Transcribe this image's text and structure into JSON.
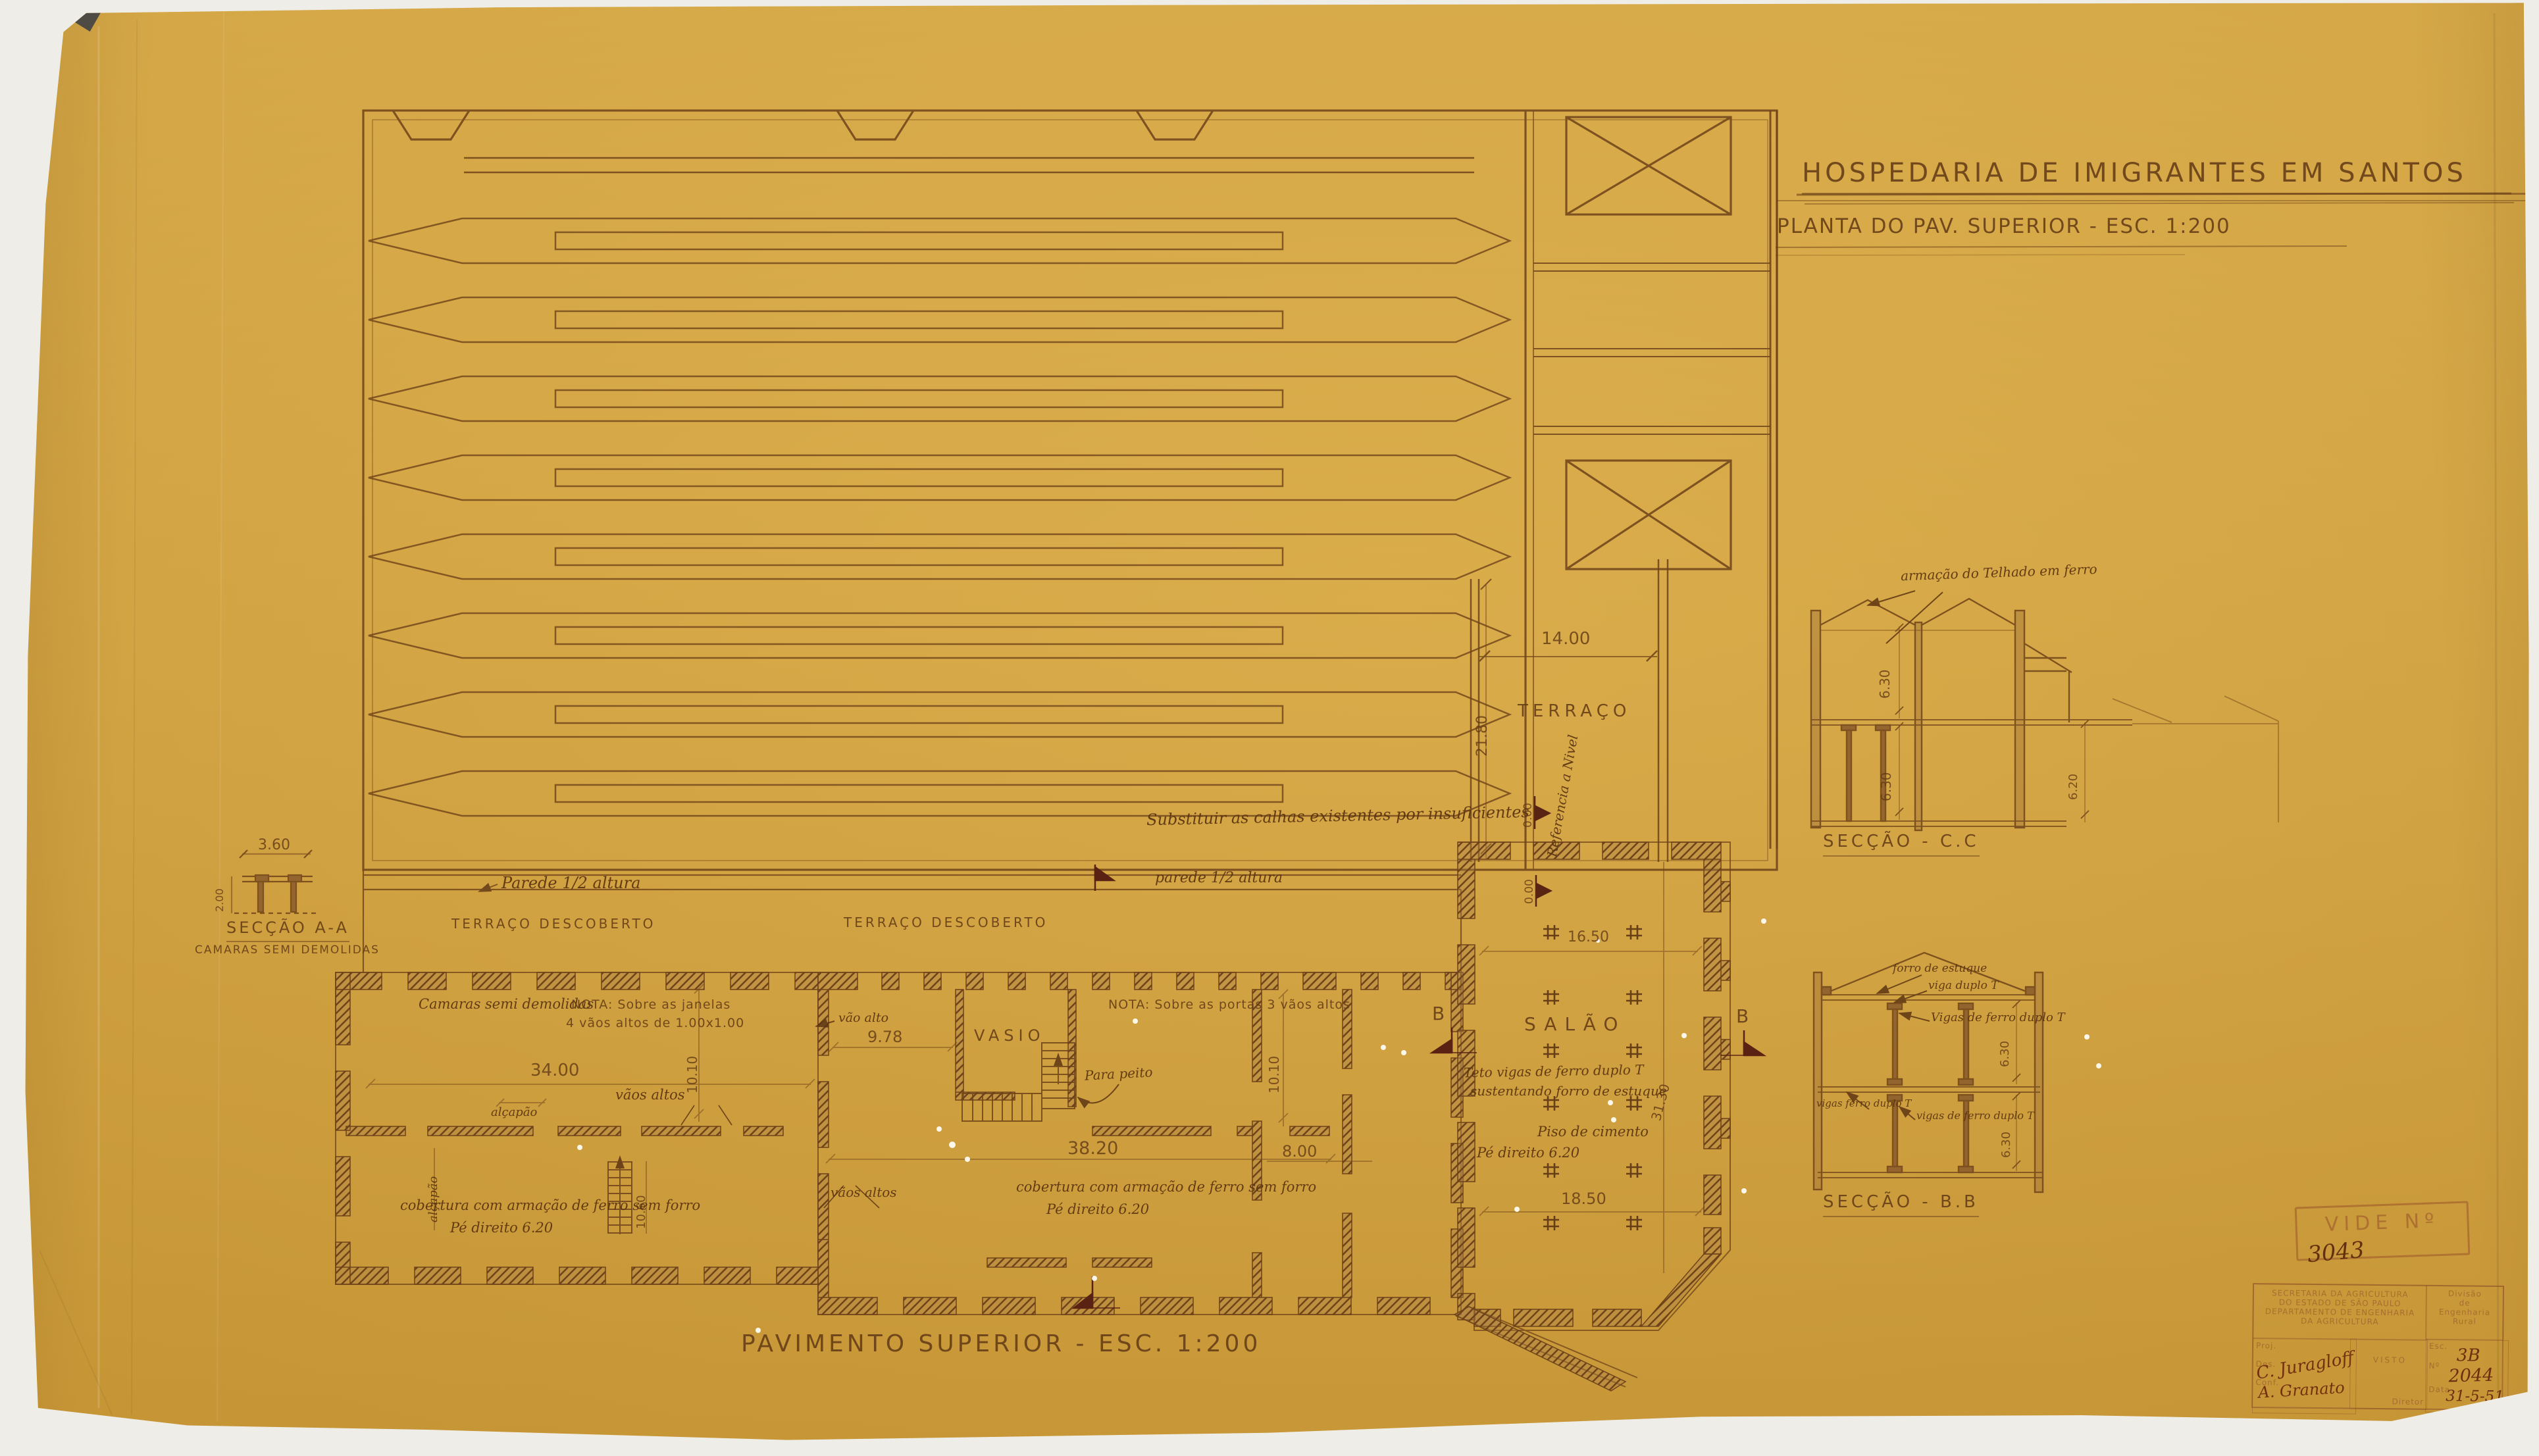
{
  "sheet": {
    "size_note": "53x95",
    "title1": "HOSPEDARIA DE IMIGRANTES EM SANTOS",
    "title2": "PLANTA DO PAV. SUPERIOR - ESC. 1:200",
    "caption": "PAVIMENTO SUPERIOR - ESC. 1:200"
  },
  "roof": {
    "gutter_note": "Substituir as calhas existentes por insuficientes",
    "half_wall_left": "Parede 1/2 altura",
    "half_wall_right": "parede 1/2 altura"
  },
  "terrace": {
    "label": "TERRAÇO",
    "w": "14.00",
    "d": "21.80",
    "ref": "Referencia a Nivel",
    "lvl1": "0.00",
    "lvl2": "0.00",
    "open_left": "TERRAÇO DESCOBERTO",
    "open_center": "TERRAÇO DESCOBERTO"
  },
  "left_block": {
    "chambers": "Camaras semi demolidas",
    "nota1": "NOTA: Sobre as janelas",
    "nota2": "4 vãos altos de 1.00x1.00",
    "w": "34.00",
    "vaos": "vãos altos",
    "alcapao": "alçapão",
    "alcapao_v": "alçapão",
    "d": "10.10",
    "stair": "10.60",
    "roof1": "cobertura com armação de ferro sem forro",
    "roof2": "Pé direito 6.20",
    "vaos2": "vãos altos"
  },
  "mid_block": {
    "vao": "vão alto",
    "w978": "9.78",
    "vasio": "VASIO",
    "peito": "Para peito",
    "nota": "NOTA: Sobre as portas 3 vãos altos",
    "d": "10.10",
    "w": "38.20",
    "w8": "8.00",
    "roof1": "cobertura com armação de ferro sem forro",
    "roof2": "Pé direito 6.20"
  },
  "salao": {
    "label": "SALÃO",
    "teto1": "Teto vigas de ferro duplo T",
    "teto2": "sustentando forro de estuque",
    "piso": "Piso de cimento",
    "pe": "Pé direito 6.20",
    "w": "16.50",
    "w2": "18.50",
    "d": "31.30"
  },
  "marks": {
    "bl": "B",
    "br": "B"
  },
  "sa": {
    "t": "SECÇÃO A-A",
    "sub": "CAMARAS SEMI DEMOLIDAS",
    "w": "3.60",
    "h": "2.00"
  },
  "sc": {
    "t": "SECÇÃO - C.C",
    "note": "armação do Telhado em ferro",
    "d1": "6.30",
    "d2": "6.30",
    "d3": "6.20"
  },
  "sb": {
    "t": "SECÇÃO - B.B",
    "n1": "forro de estuque",
    "n2": "viga duplo T",
    "n3": "Vigas de ferro duplo T",
    "n4": "vigas ferro duplo T",
    "n5": "vigas de ferro duplo T",
    "d1": "6.30",
    "d2": "6.30"
  },
  "vide": {
    "label": "VIDE Nº",
    "num": "3043"
  },
  "tb": {
    "o1": "SECRETARIA DA AGRICULTURA",
    "o2": "DO ESTADO DE SÃO PAULO",
    "o3": "DEPARTAMENTO DE ENGENHARIA",
    "o4": "DA AGRICULTURA",
    "d1": "Divisão",
    "d2": "de",
    "d3": "Engenharia",
    "d4": "Rural",
    "proj": "Proj.",
    "des": "Des.",
    "conf": "Conf.",
    "visto": "VISTO",
    "dir": "Diretor",
    "esc": "Esc.",
    "no": "Nº",
    "data": "Data",
    "sig1": "C. Juragloff",
    "sig2": "A. Granato",
    "reg": "3B",
    "num": "2044",
    "date": "31-5-51"
  }
}
